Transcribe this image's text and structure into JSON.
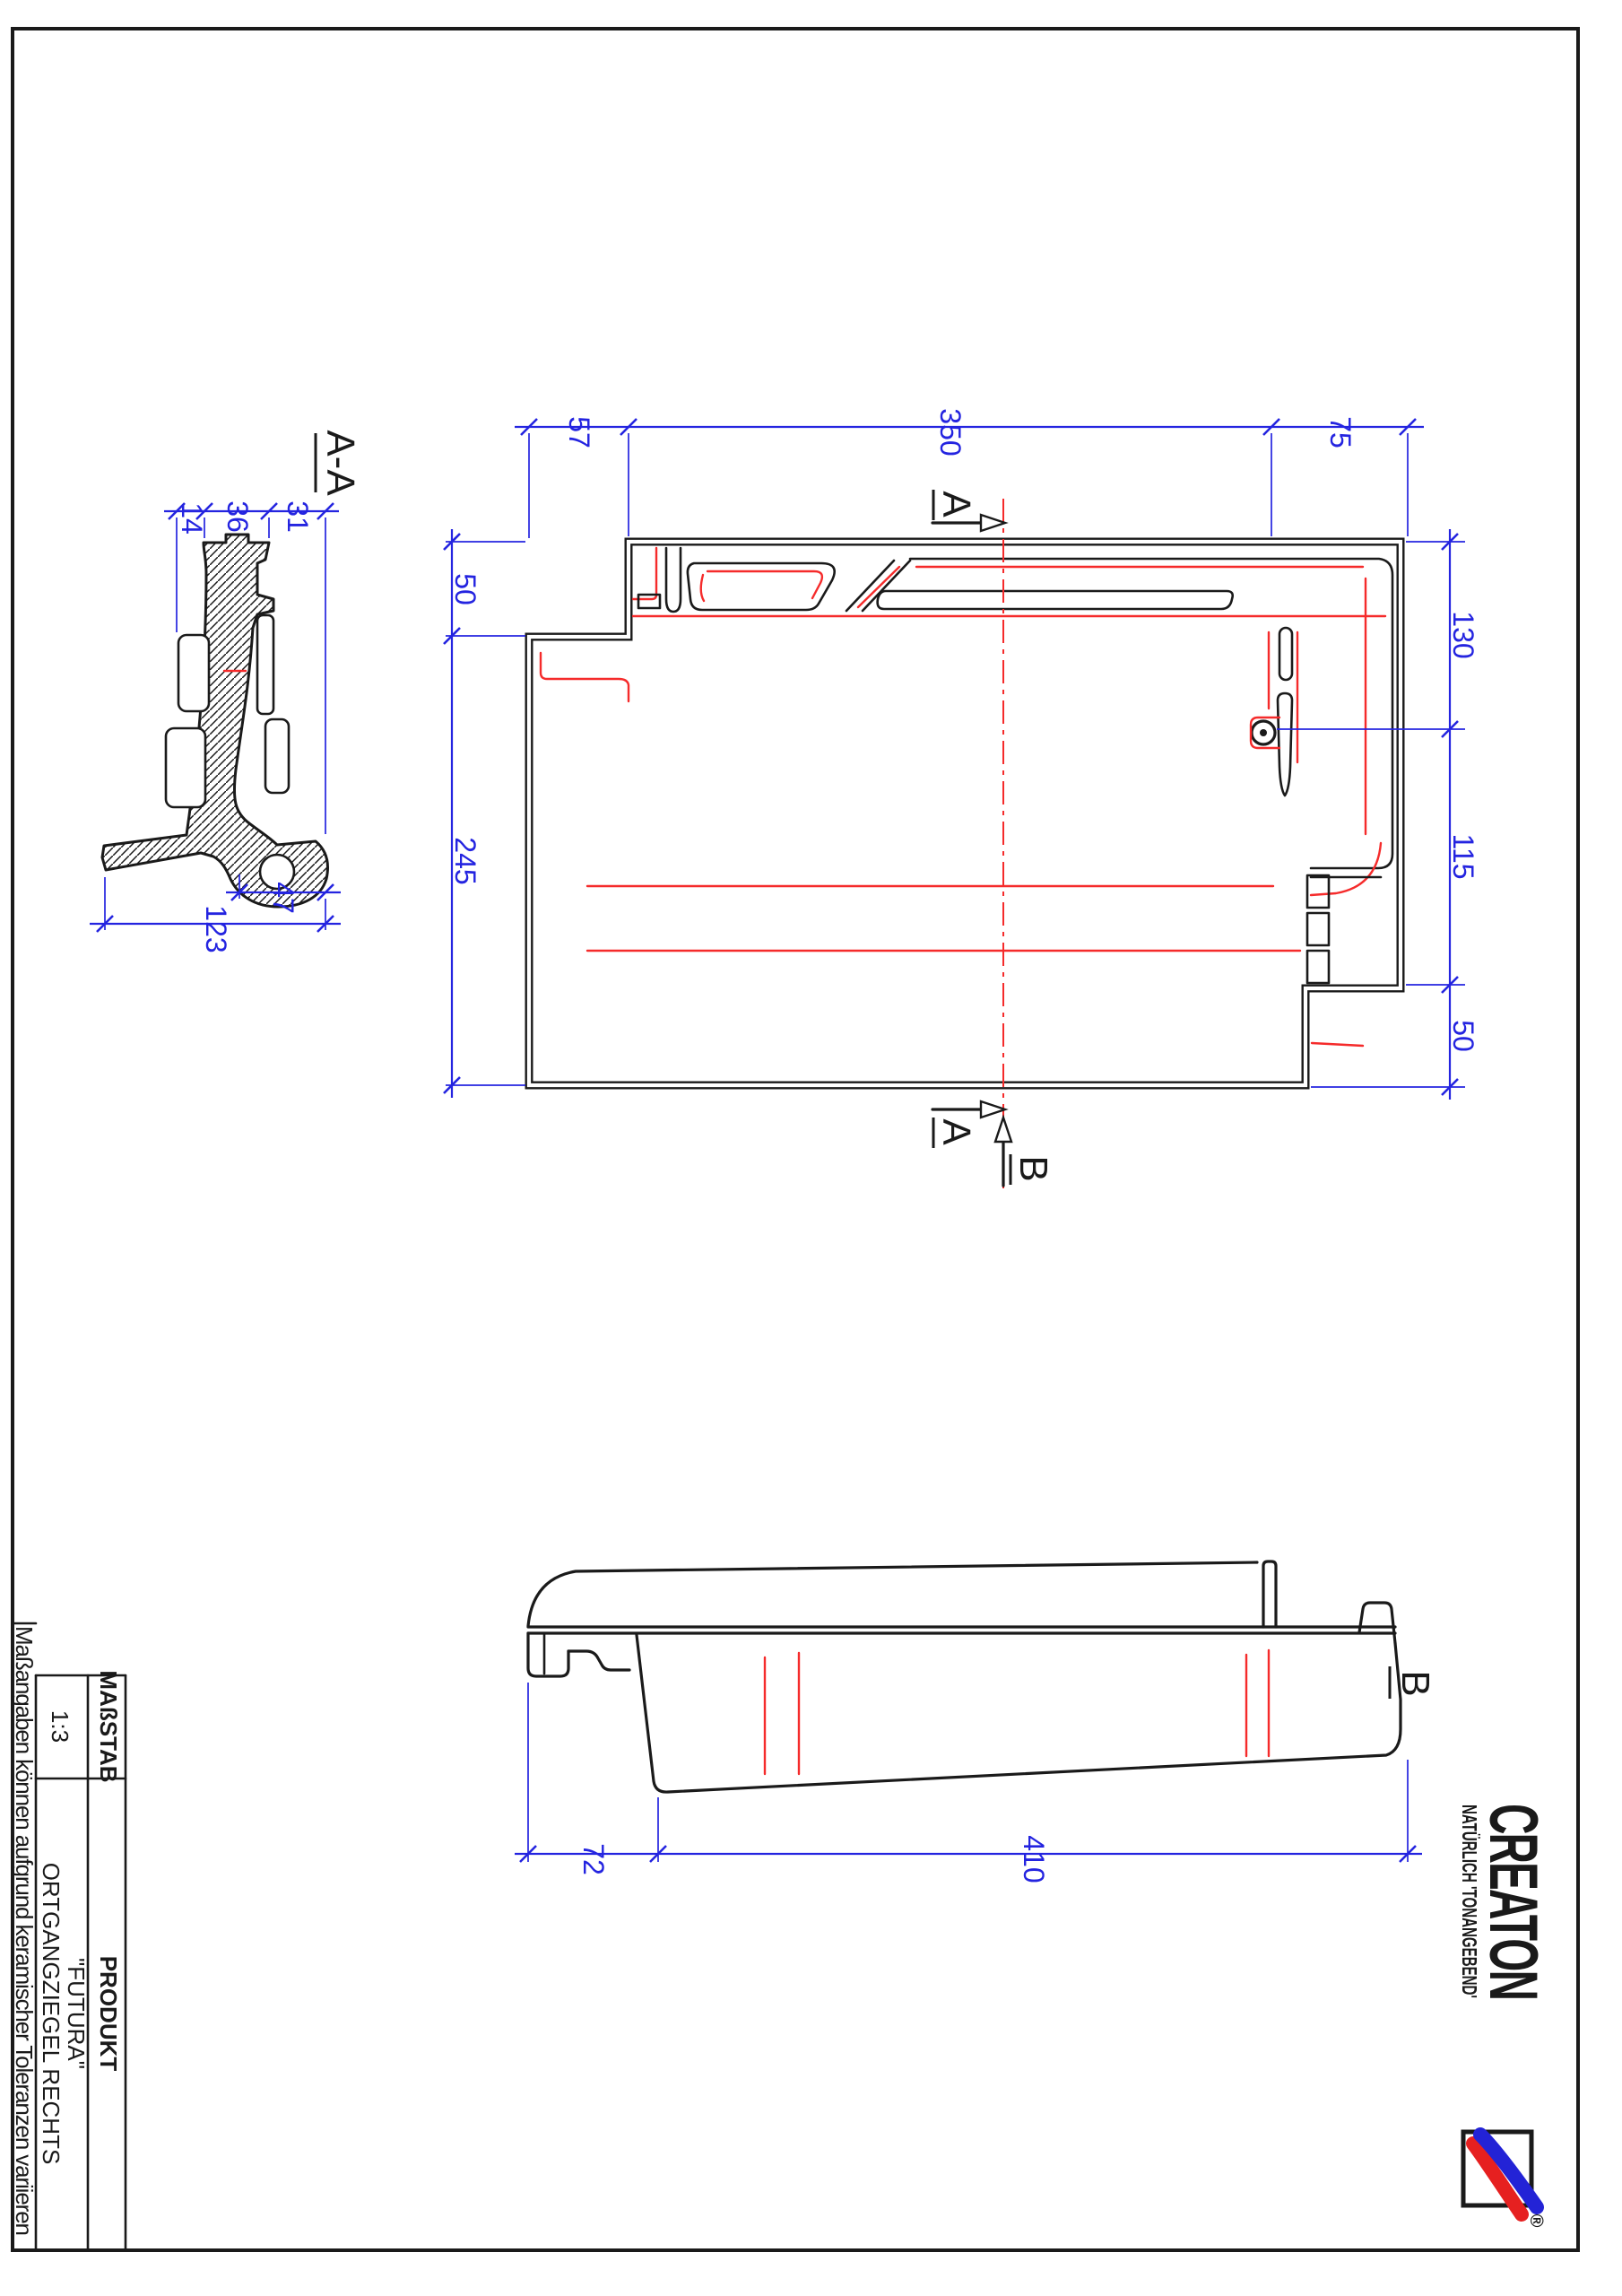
{
  "page": {
    "background": "#ffffff",
    "border_color": "#1a1a1a"
  },
  "colors": {
    "dimension_blue": "#2424e0",
    "feature_red": "#f52b2b",
    "line_black": "#1a1a1a",
    "logo_blue": "#2323d6",
    "logo_red": "#e62020"
  },
  "section_aa": {
    "label": "A-A",
    "dims": {
      "d14": "14",
      "d36": "36",
      "d31": "31",
      "d47": "47",
      "d123": "123"
    }
  },
  "plan": {
    "dims": {
      "d57": "57",
      "d350": "350",
      "d75": "75",
      "d50_left": "50",
      "d245": "245",
      "d130": "130",
      "d115": "115",
      "d50_right": "50"
    },
    "cut_labels": {
      "a_top": "A",
      "a_bottom": "A",
      "b": "B"
    }
  },
  "b_view": {
    "label": "B",
    "dims": {
      "d72": "72",
      "d410": "410"
    }
  },
  "title_block": {
    "scale_header": "MAßSTAB",
    "scale_value": "1:3",
    "product_header": "PRODUKT",
    "product_line1": "\"FUTURA\"",
    "product_line2": "ORTGANGZIEGEL RECHTS",
    "disclaimer": "Maßangaben können aufgrund keramischer Toleranzen variieren"
  },
  "logo": {
    "brand": "CREATON",
    "tagline": "NATÜRLICH 'TONANGEBEND'",
    "registered": "®"
  }
}
